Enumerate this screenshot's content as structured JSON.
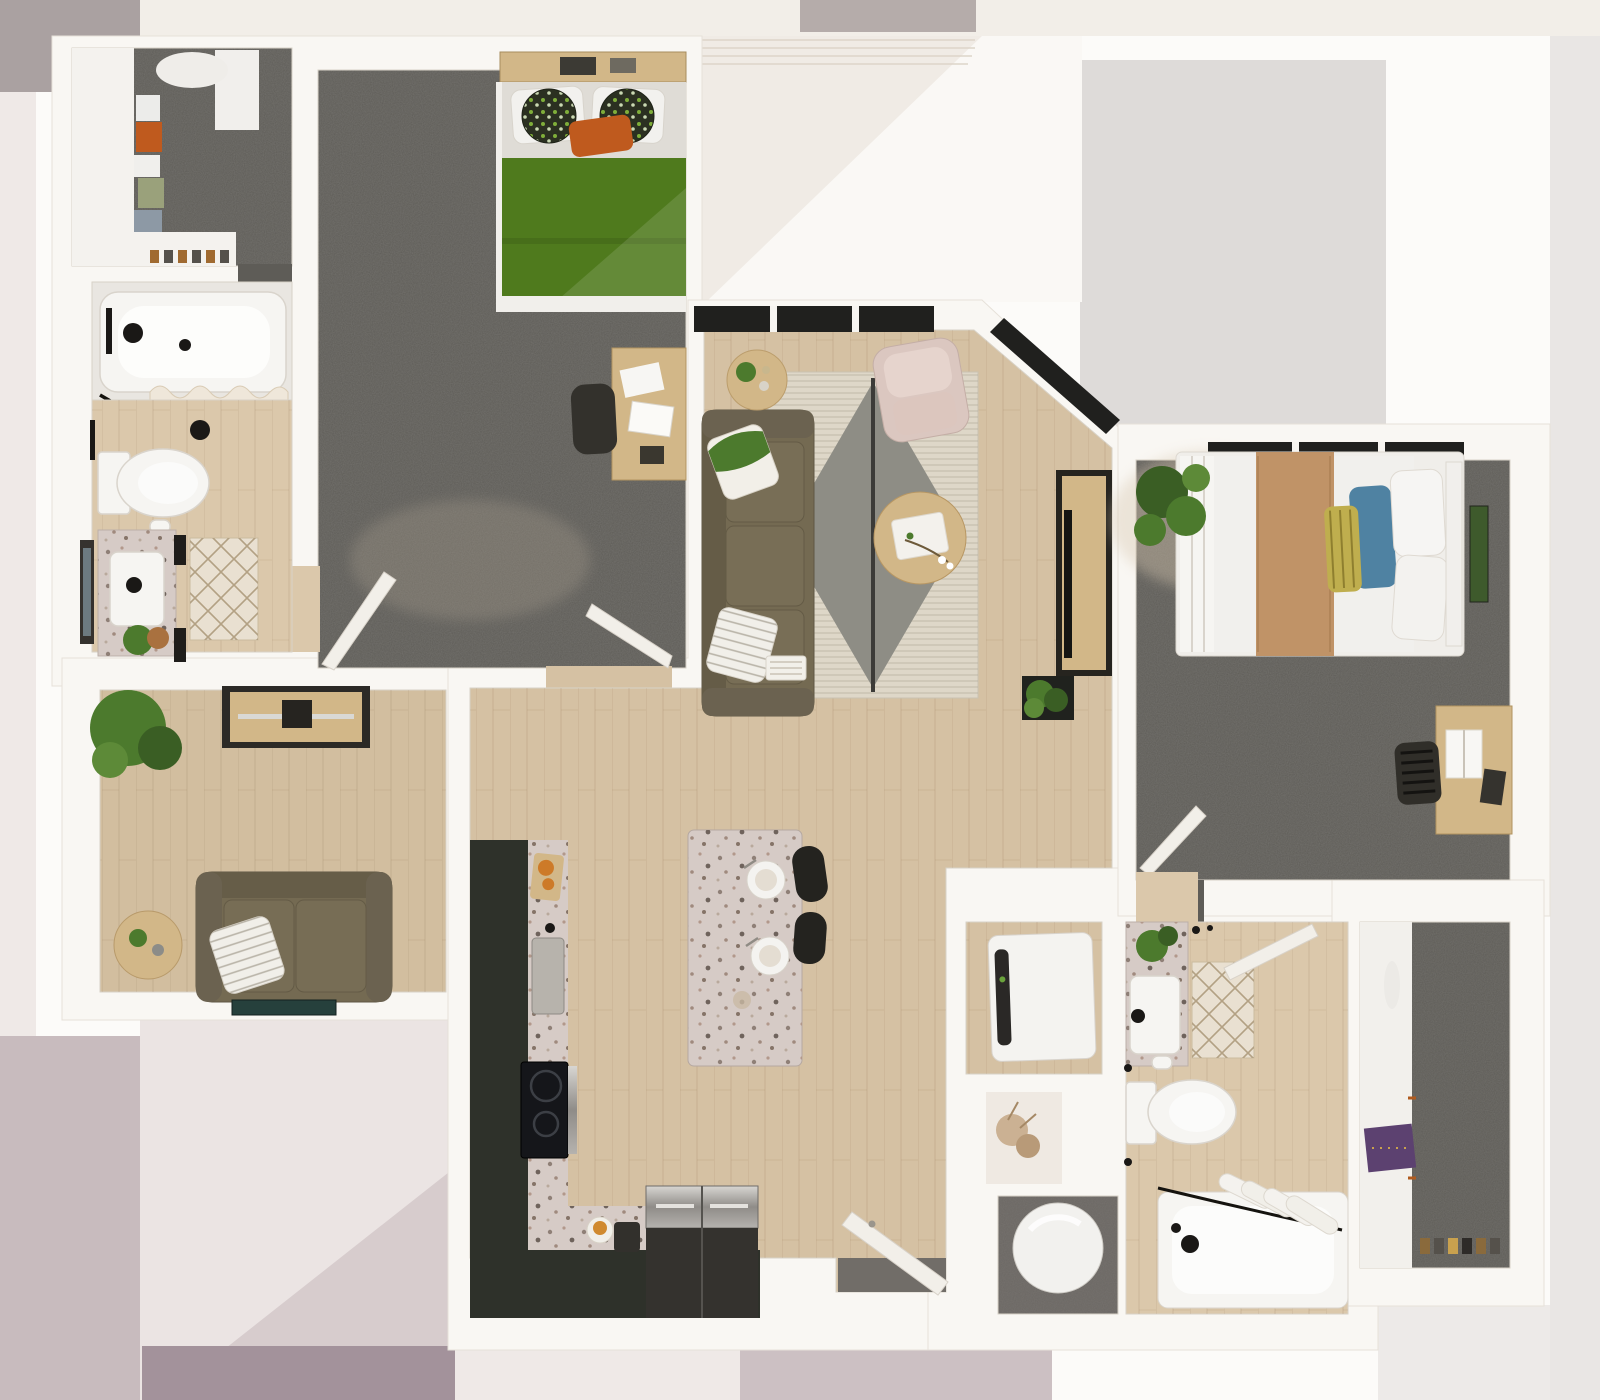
{
  "title": "Top-down 3D rendered apartment floor plan with two bedrooms, two bathrooms, den, open kitchen and living area",
  "colors": {
    "carpet": "#5e5c57",
    "wood_main": "#d5c1a3",
    "wood_den": "#d2be9f",
    "wood_bath": "#dbc8ab",
    "cabinet": "#2e312a",
    "terrazzo": "#cfc4be",
    "sink_steel": "#b7b3ac",
    "duvet_green": "#4f7a1d",
    "pillow_orange": "#bf5a1e",
    "sofa": "#746a52",
    "sofa_trim": "#655c47",
    "armchair": "#dbc7c0",
    "rug_cream": "#ded7c8",
    "rug_gray": "#8e8d85",
    "table_wood": "#d2b788",
    "bed_white": "#f1f0ed",
    "runner_tan": "#c09367",
    "pillow_blue": "#4f82a2",
    "pillow_yellow": "#bfae4e",
    "plant": "#4c7a2d",
    "plant_dark": "#3a5e24",
    "tub": "#f6f5f2",
    "stool": "#24231f",
    "door": "#f2efe9",
    "mat": "#e9e0d1",
    "garment_purple": "#5c4170",
    "heater_floor": "#6b6763",
    "window_glass": "#20201e",
    "entry_mat": "#716d68",
    "washer": "#f4f3f0"
  },
  "rooms": [
    {
      "id": "walk-in-closet-1",
      "name": "Walk-in closet (top left)"
    },
    {
      "id": "bedroom-1",
      "name": "Bedroom 1 with green bed"
    },
    {
      "id": "bathroom-1",
      "name": "Bathroom 1 with tub, toilet and vanity"
    },
    {
      "id": "den",
      "name": "Den with loveseat and media console"
    },
    {
      "id": "living-room",
      "name": "Living room with sofa, armchair and rug"
    },
    {
      "id": "kitchen",
      "name": "Kitchen with dark cabinets and island"
    },
    {
      "id": "entry-hall",
      "name": "Entry hall with front door"
    },
    {
      "id": "bedroom-2",
      "name": "Bedroom 2 with tan runner bed"
    },
    {
      "id": "laundry-closet",
      "name": "Laundry closet with washer"
    },
    {
      "id": "water-heater-closet",
      "name": "Water heater closet"
    },
    {
      "id": "bathroom-2",
      "name": "Bathroom 2 with tub and vanity"
    },
    {
      "id": "walk-in-closet-2",
      "name": "Walk-in closet (bottom right)"
    },
    {
      "id": "balcony",
      "name": "Balcony / exterior area"
    }
  ],
  "furniture": [
    "green queen bed",
    "desk with chair (bedroom 1)",
    "bathtub",
    "toilet",
    "terrazzo vanity",
    "brown sofa",
    "pink armchair",
    "round coffee table",
    "tv console",
    "area rug",
    "kitchen island with stools",
    "cooktop",
    "refrigerator",
    "loveseat",
    "media console",
    "bed with tan runner",
    "desk with chair (bedroom 2)",
    "washer dryer",
    "water heater",
    "second bathtub",
    "second toilet",
    "hanging clothes"
  ]
}
